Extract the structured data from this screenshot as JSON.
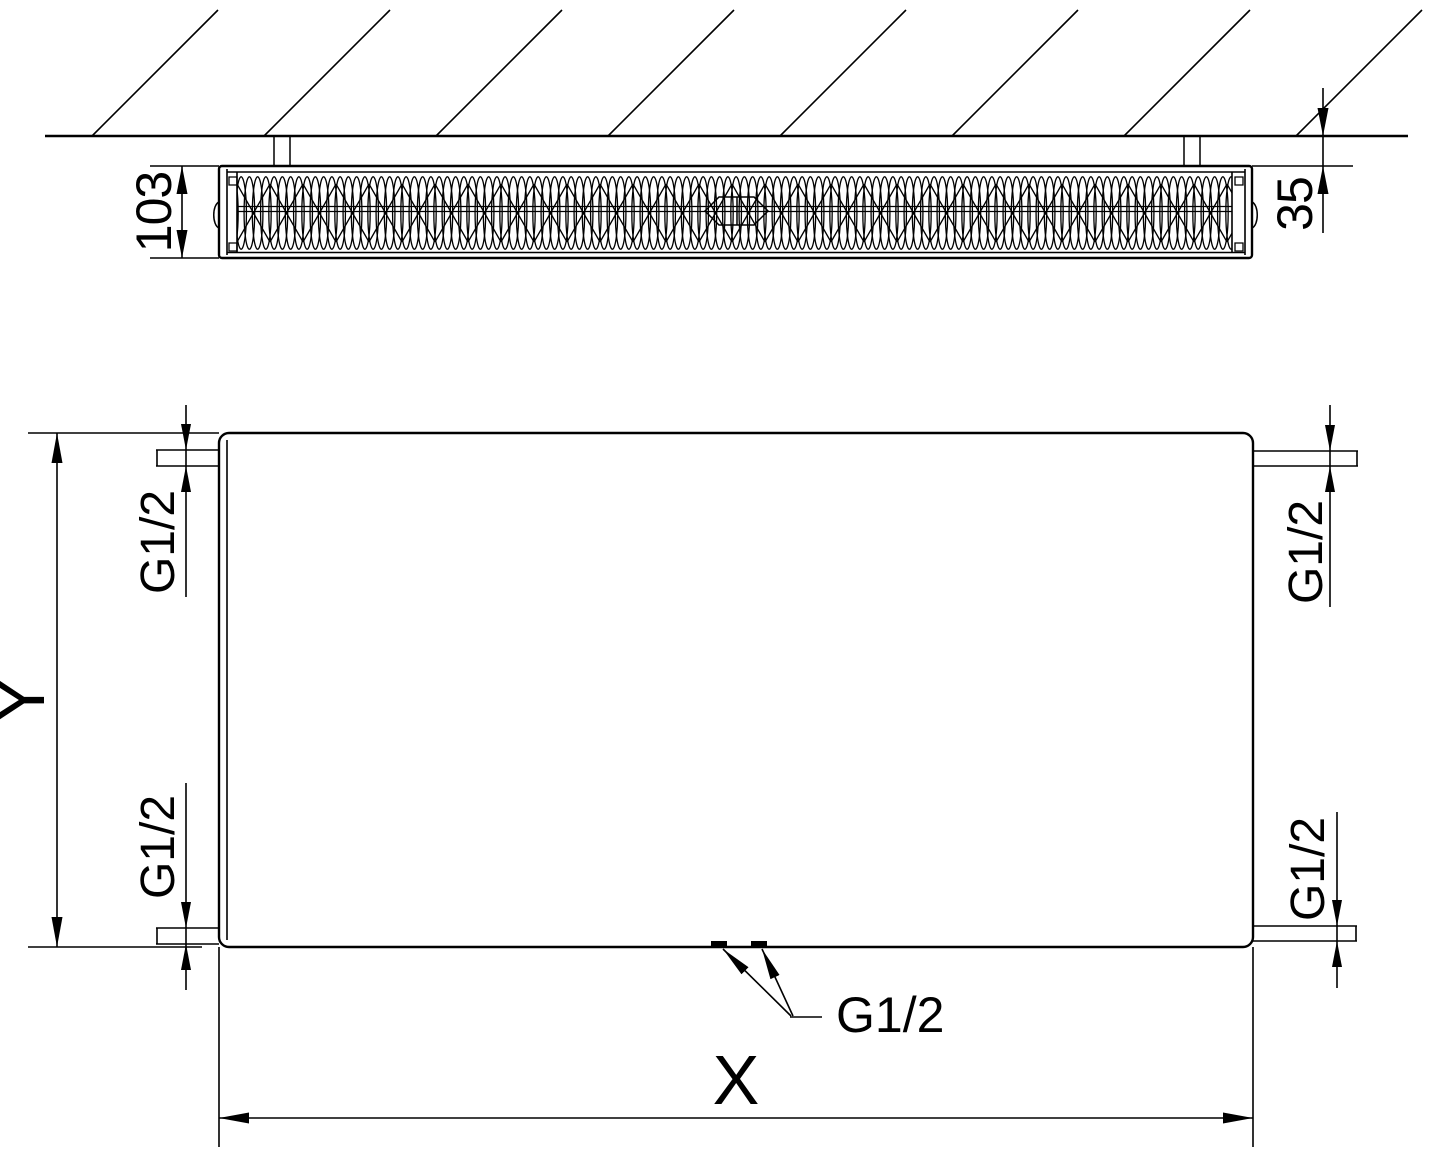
{
  "drawing": {
    "background": "#ffffff",
    "line_color": "#000000",
    "top_view": {
      "label_depth": "103",
      "label_wall_distance": "35"
    },
    "front_view": {
      "label_height": "Y",
      "label_width": "X",
      "connection_top_left": "G1/2",
      "connection_bottom_left": "G1/2",
      "connection_top_right": "G1/2",
      "connection_bottom_right": "G1/2",
      "connection_bottom_center": "G1/2"
    }
  }
}
